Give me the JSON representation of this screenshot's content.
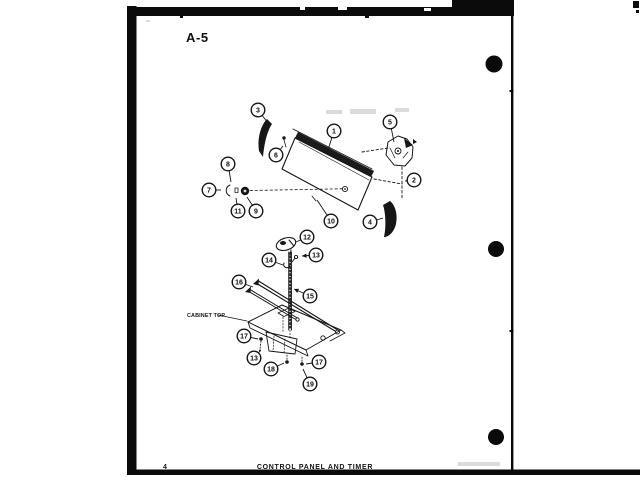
{
  "page": {
    "header_label": "A-5",
    "footer_page_number": "4",
    "footer_title": "CONTROL PANEL AND TIMER"
  },
  "scan": {
    "ink_color": "#161616",
    "edge_color": "#0b0b0b",
    "hole_color": "#0a0a0a",
    "noise_color": "#9a9a9a"
  },
  "diagram": {
    "cabinet_top_label": "CABINET TOP",
    "callouts": [
      {
        "n": "1",
        "cx": 334,
        "cy": 131,
        "tx": 327,
        "ty": 153
      },
      {
        "n": "2",
        "cx": 414,
        "cy": 180,
        "tx": 405,
        "ty": 181
      },
      {
        "n": "3",
        "cx": 258,
        "cy": 110,
        "tx": 268,
        "ty": 123
      },
      {
        "n": "4",
        "cx": 370,
        "cy": 222,
        "tx": 383,
        "ty": 218
      },
      {
        "n": "5",
        "cx": 390,
        "cy": 122,
        "tx": 394,
        "ty": 142
      },
      {
        "n": "6",
        "cx": 276,
        "cy": 155,
        "tx": 283,
        "ty": 146
      },
      {
        "n": "7",
        "cx": 209,
        "cy": 190,
        "tx": 221,
        "ty": 190
      },
      {
        "n": "8",
        "cx": 228,
        "cy": 164,
        "tx": 231,
        "ty": 182
      },
      {
        "n": "9",
        "cx": 256,
        "cy": 211,
        "tx": 247,
        "ty": 197
      },
      {
        "n": "10",
        "cx": 331,
        "cy": 221,
        "tx": 317,
        "ty": 200
      },
      {
        "n": "11",
        "cx": 238,
        "cy": 211,
        "tx": 236,
        "ty": 198
      },
      {
        "n": "12",
        "cx": 307,
        "cy": 237,
        "tx": 296,
        "ty": 242
      },
      {
        "n": "13",
        "cx": 316,
        "cy": 255,
        "tx": 302,
        "ty": 256,
        "arrow": true
      },
      {
        "n": "14",
        "cx": 269,
        "cy": 260,
        "tx": 283,
        "ty": 265
      },
      {
        "n": "15",
        "cx": 310,
        "cy": 296,
        "tx": 294,
        "ty": 289,
        "arrow": true
      },
      {
        "n": "16",
        "cx": 239,
        "cy": 282,
        "tx": 253,
        "ty": 287
      },
      {
        "n": "17",
        "cx": 244,
        "cy": 336,
        "tx": 258,
        "ty": 339
      },
      {
        "n": "13",
        "cx": 254,
        "cy": 358,
        "tx": 260,
        "ty": 351
      },
      {
        "n": "18",
        "cx": 271,
        "cy": 369,
        "tx": 284,
        "ty": 363
      },
      {
        "n": "17",
        "cx": 319,
        "cy": 362,
        "tx": 306,
        "ty": 364
      },
      {
        "n": "19",
        "cx": 310,
        "cy": 384,
        "tx": 303,
        "ty": 369
      }
    ]
  }
}
